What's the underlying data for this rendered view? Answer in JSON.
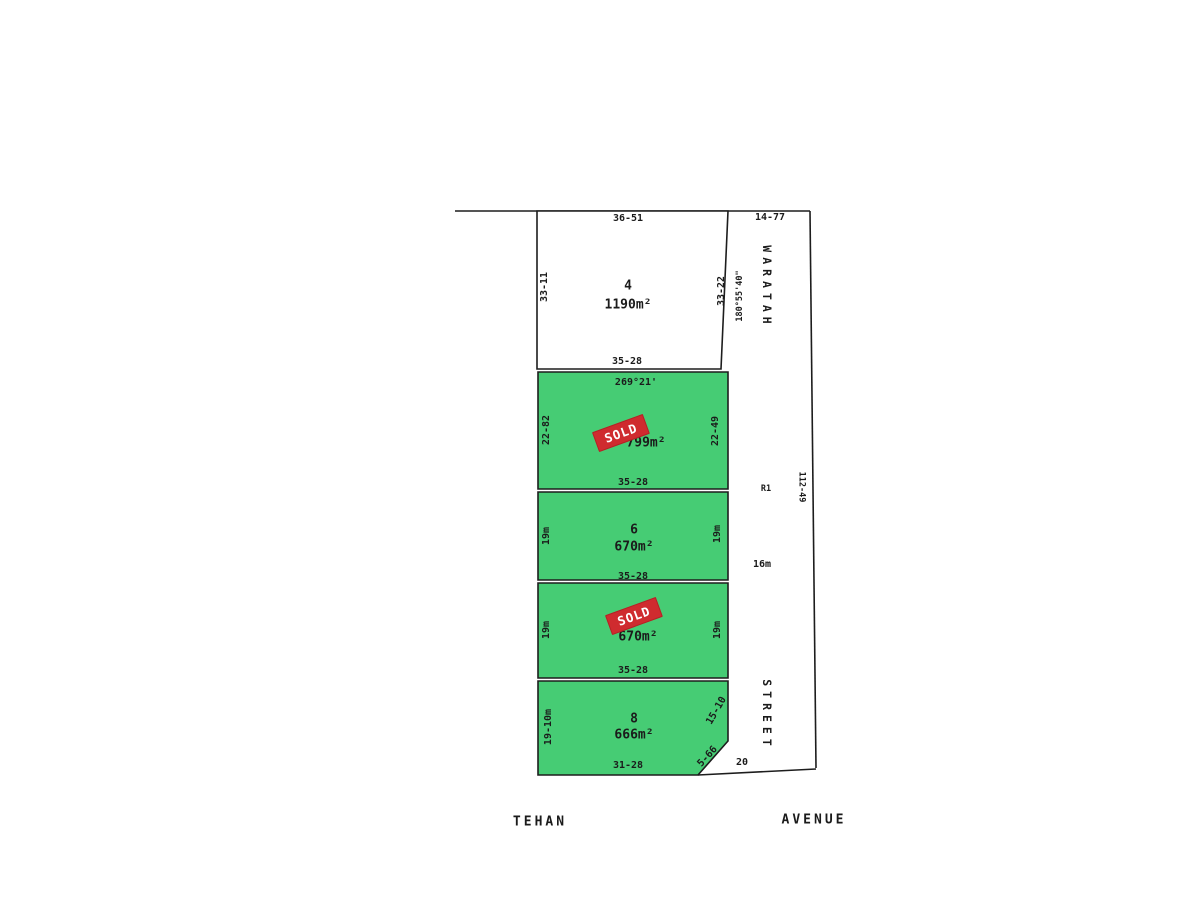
{
  "colors": {
    "lot_green": "#46cc74",
    "sold_red": "#cf2b2f",
    "line": "#1d1d1d",
    "background": "#ffffff"
  },
  "badge": {
    "sold": "SOLD"
  },
  "streets": {
    "east_name_upper": "WARATAH",
    "east_name_lower": "STREET",
    "south_name_left": "TEHAN",
    "south_name_right": "AVENUE",
    "east_top_width": "14-77",
    "east_reserve": "R1",
    "east_carriage_width": "16m",
    "east_length": "112-49",
    "south_width": "20"
  },
  "lots": {
    "lot4": {
      "number": "4",
      "area": "1190m²",
      "top": "36-51",
      "left": "33-11",
      "right": "33-22",
      "bearing": "180°55'40\"",
      "bottom": "35-28"
    },
    "lot5": {
      "bearing": "269°21'",
      "area": "799m²",
      "left": "22-82",
      "right": "22-49",
      "bottom": "35-28"
    },
    "lot6": {
      "number": "6",
      "area": "670m²",
      "left": "19m",
      "right": "19m",
      "bottom": "35-28"
    },
    "lot7": {
      "area": "670m²",
      "left": "19m",
      "right": "19m",
      "bottom": "35-28"
    },
    "lot8": {
      "number": "8",
      "area": "666m²",
      "left": "19-10m",
      "right": "15-10",
      "chamfer": "5-66",
      "bottom": "31-28"
    }
  }
}
